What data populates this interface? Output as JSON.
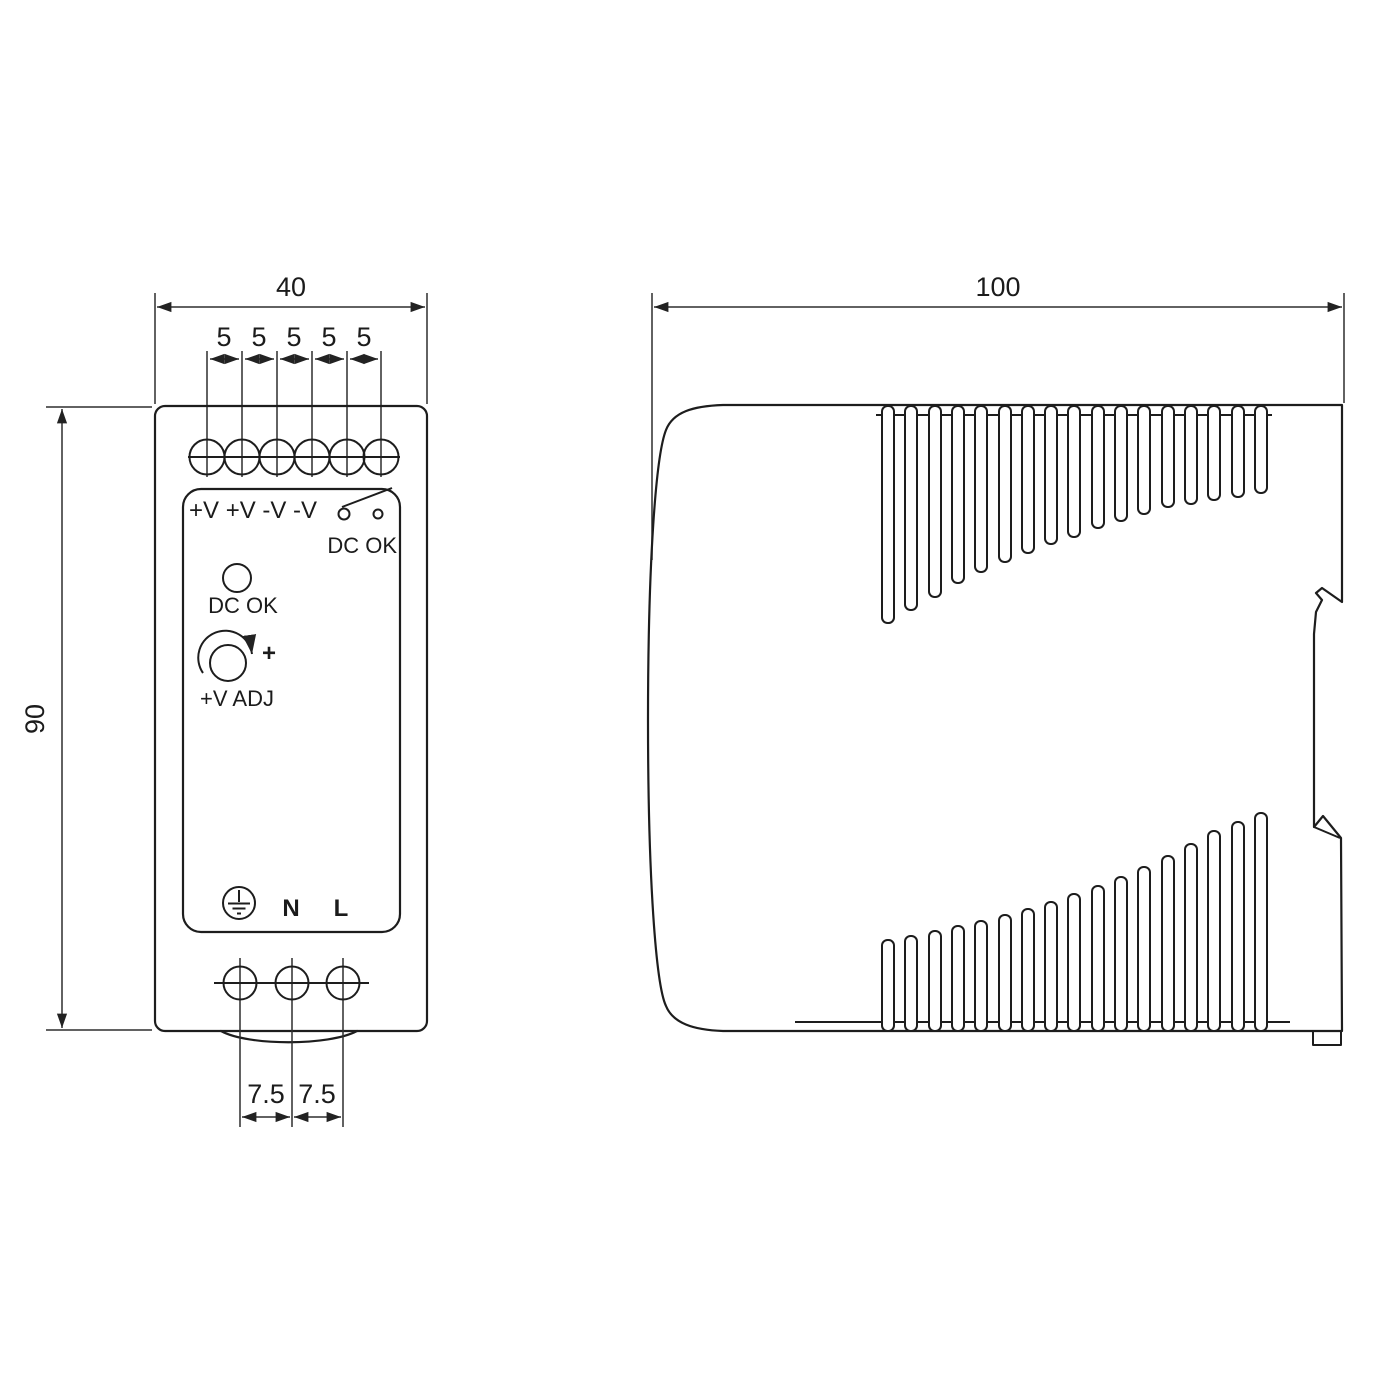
{
  "page": {
    "title": "din-rail-power-supply-dimension-drawing",
    "background": "#ffffff"
  },
  "colors": {
    "line": "#1d1d1d",
    "dim_line": "#2e2e2e",
    "text": "#1b1b1b",
    "background": "#ffffff"
  },
  "front_view": {
    "dim_width": "40",
    "dim_screw_pitch": [
      "5",
      "5",
      "5",
      "5",
      "5"
    ],
    "dim_height": "90",
    "dim_input_pitch": [
      "7.5",
      "7.5"
    ],
    "panel": {
      "output_terminals_label": "+V +V -V -V",
      "relay_contact_label": "DC OK",
      "led_label": "DC OK",
      "adjust_plus": "+",
      "adjust_label": "+V ADJ",
      "neutral_label": "N",
      "line_label": "L"
    }
  },
  "side_view": {
    "dim_depth": "100"
  },
  "icons": {
    "screw-terminal-icon": "circle-with-cross-slot",
    "relay-contact-icon": "switch-contact-symbol",
    "led-indicator-icon": "small-circle",
    "potentiometer-icon": "circle-with-rotation-arrow",
    "protective-earth-icon": "circled-ground-symbol",
    "din-rail-clip-icon": "hooked-side-profile",
    "vent-slots-icon": "rounded-slot-array"
  }
}
